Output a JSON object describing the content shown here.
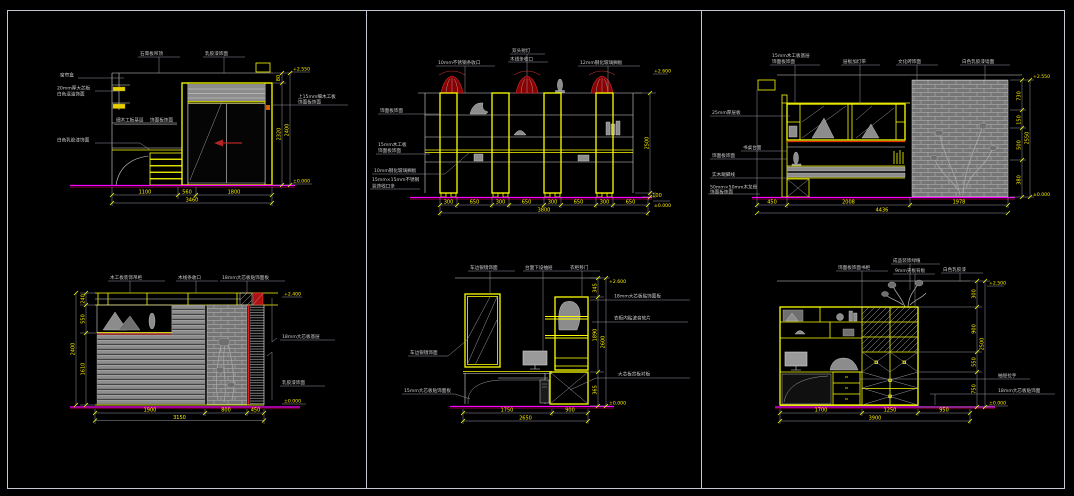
{
  "window": {
    "type": "cad-elevation-sheet",
    "background": "#000000",
    "frame_color": "#c4c8d4"
  },
  "colors": {
    "line": "#d6d6d6",
    "accent_yellow": "#ffff00",
    "baseline_magenta": "#ff00ff",
    "red_accent": "#e02020",
    "gray_fill": "#8c8c8c"
  },
  "panels": {
    "top_left": {
      "top_labels": [
        "石膏板吊顶",
        "乳胶漆饰面"
      ],
      "left_labels": [
        "窗帘盒",
        "20mm厚大芯板",
        "白色混油饰面",
        "细木工板基层",
        "饰面板饰面",
        "白色乳胶漆饰面"
      ],
      "right_labels": [
        "上15mm细木工板",
        "饰面板饰面"
      ],
      "dims_bottom": [
        "1100",
        "560",
        "1800"
      ],
      "dim_total": "3460",
      "dims_right": [
        "80",
        "2320"
      ],
      "dim_right_total": "2400",
      "marker_top": "+2.550",
      "marker_bottom": "±0.000"
    },
    "top_middle": {
      "top_labels": [
        "10mm不锈钢条收口",
        "双头射灯",
        "木线条收口",
        "12mm钢化玻璃搁板"
      ],
      "left_labels": [
        "饰面板饰面",
        "15mm木工板",
        "饰面板饰面",
        "10mm钢化玻璃搁板",
        "15mm×15mm不锈钢",
        "装饰收口条"
      ],
      "dims_bottom": [
        "300",
        "650",
        "300",
        "650",
        "300",
        "650",
        "300",
        "650"
      ],
      "dim_total": "3800",
      "dims_right": [
        "2500",
        "100"
      ],
      "marker_top": "+2.600",
      "marker_bottom": "±0.000"
    },
    "top_right": {
      "top_labels": [
        "15mm木工板基层",
        "饰面板饰面",
        "层板加灯带",
        "文化砖饰面",
        "白色乳胶漆墙面"
      ],
      "left_labels": [
        "25mm厚层板",
        "书桌台面",
        "饰面板饰面",
        "实木踢脚线",
        "50mm×50mm木龙骨",
        "饰面板饰面"
      ],
      "dims_bottom": [
        "450",
        "2008",
        "1978"
      ],
      "dim_total": "4436",
      "dims_right": [
        "730",
        "150",
        "500",
        "380"
      ],
      "dim_right_total": "2550",
      "marker_top": "+2.550",
      "marker_bottom": "±0.000"
    },
    "bottom_left": {
      "top_labels": [
        "木工板装饰吊柜",
        "木线条收口",
        "18mm大芯板贴饰面板"
      ],
      "right_labels": [
        "18mm大芯板基层",
        "乳胶漆饰面"
      ],
      "dims_left": [
        "240",
        "550",
        "1610"
      ],
      "dim_left_total": "2400",
      "dims_bottom": [
        "1900",
        "800",
        "450"
      ],
      "dim_total": "3150",
      "marker_top": "+2.400",
      "marker_bottom": "±0.000"
    },
    "bottom_middle": {
      "top_labels": [
        "车边银镜饰面",
        "台面下设抽屉",
        "衣柜移门"
      ],
      "left_labels": [
        "车边银镜饰面",
        "15mm大芯板贴饰面板"
      ],
      "right_labels": [
        "18mm大芯板贴饰面板",
        "衣柜内贴波音软片",
        "大芯板背板衬板"
      ],
      "dims_bottom": [
        "1750",
        "900"
      ],
      "dim_total": "2650",
      "dims_right": [
        "345",
        "1890",
        "365"
      ],
      "dim_right_total": "2600",
      "marker_top": "+2.600",
      "marker_bottom": "±0.000"
    },
    "bottom_right": {
      "top_labels": [
        "饰面板饰面书柜",
        "成品装饰绿植",
        "9mm夹板背板",
        "白色乳胶漆"
      ],
      "right_labels": [
        "抽屉拉手",
        "18mm大芯板贴饰面"
      ],
      "dims_bottom": [
        "1700",
        "1250",
        "950"
      ],
      "dim_total": "3900",
      "dims_right": [
        "300",
        "900",
        "550",
        "750"
      ],
      "dim_right_total": "2500",
      "marker_top": "+2.500",
      "marker_bottom": "±0.000"
    }
  }
}
